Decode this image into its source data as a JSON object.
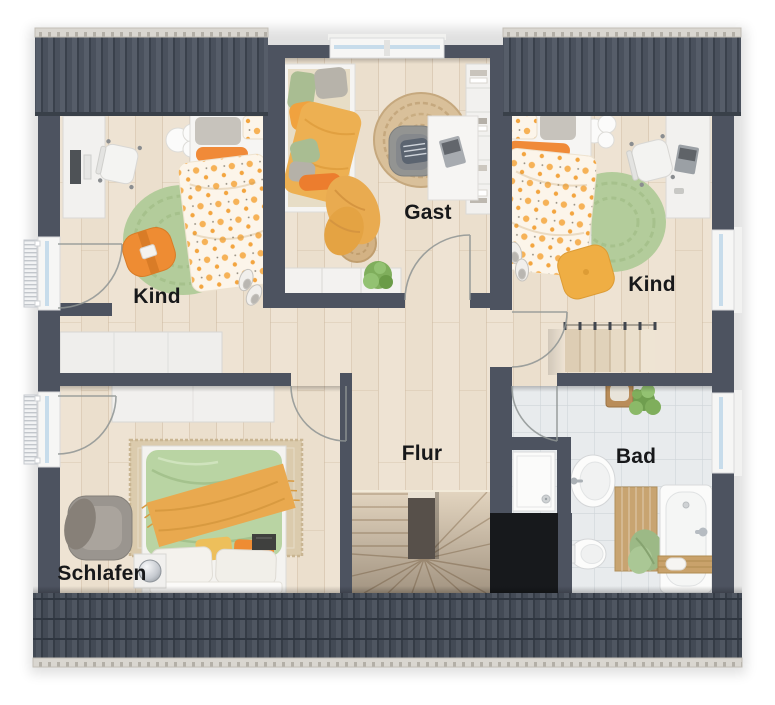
{
  "plan": {
    "type": "floor-plan",
    "rooms": [
      {
        "id": "kind-left",
        "label": "Kind",
        "furniture": [
          "desk",
          "desk-chair",
          "single-bed",
          "cloud-side-table",
          "round-rug",
          "pouf",
          "slippers"
        ]
      },
      {
        "id": "gast",
        "label": "Gast",
        "furniture": [
          "single-bed",
          "throw-blanket",
          "round-pouf",
          "jute-rug",
          "armchair",
          "desk",
          "bookshelf",
          "sideboard",
          "plant"
        ]
      },
      {
        "id": "kind-right",
        "label": "Kind",
        "furniture": [
          "single-bed",
          "slippers",
          "cloud-side-table",
          "round-rug",
          "floor-cushion",
          "desk",
          "desk-chair"
        ]
      },
      {
        "id": "flur",
        "label": "Flur",
        "furniture": [
          "sideboard",
          "winder-staircase",
          "stair-flight"
        ]
      },
      {
        "id": "bad",
        "label": "Bad",
        "furniture": [
          "shower",
          "washbasin",
          "wall-hung-toilet",
          "bath-mat",
          "towel",
          "bathtub",
          "bath-caddy",
          "stool",
          "plant",
          "towel-rail"
        ]
      },
      {
        "id": "schlafen",
        "label": "Schlafen",
        "furniture": [
          "double-bed",
          "area-rug",
          "armchair",
          "side-table",
          "sphere-lamp",
          "wardrobe",
          "sideboard"
        ]
      }
    ],
    "windows": {
      "left_wall": 2,
      "right_wall": 2,
      "top_wall": 1,
      "radiators": 2
    },
    "roof_sections": [
      "top-left",
      "top-right",
      "bottom"
    ],
    "staircases": {
      "winder_stairwell": 1,
      "arrival_flight_steps": 6
    },
    "colors": {
      "wall": "#4d5360",
      "roof": "#4a515d",
      "ridge": "#d9d6d0",
      "floor_wood": "#ebdfcd",
      "tile": "#e8ebed",
      "accent_orange": "#f08a38",
      "accent_green": "#b3cc9b",
      "jute": "#d9c09a",
      "stair_void": "#17191c"
    }
  }
}
